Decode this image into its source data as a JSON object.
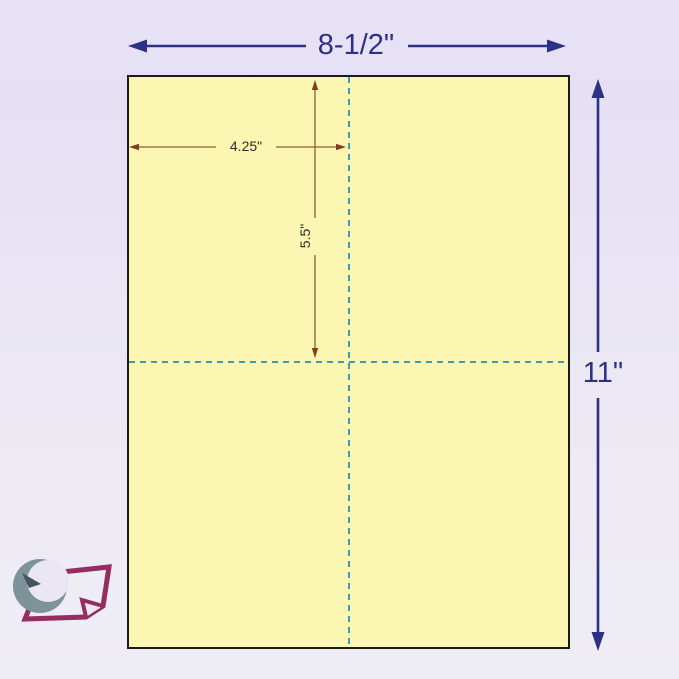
{
  "diagram": {
    "description_labels": {
      "sheet_width": "8-1/2\"",
      "sheet_height": "11\"",
      "half_width": "4.25\"",
      "half_height": "5.5\""
    },
    "sheet": {
      "panels": 4,
      "fill_color": "#fbf7b2",
      "border_color": "#1b1b1b",
      "perforation_line_color": "#3d9ab0",
      "perforation_style": "dashed"
    },
    "dimension_arrows": {
      "outer_color": "#2d3185",
      "inner_color": "#8b5e34"
    },
    "background": {
      "gradient_top": "#e8e2f7",
      "gradient_bottom": "#efedf4"
    },
    "logo": {
      "icon": "paper-clock-logo-icon",
      "paper_outline_color": "#952e5e",
      "crescent_color": "#7f929a"
    }
  }
}
